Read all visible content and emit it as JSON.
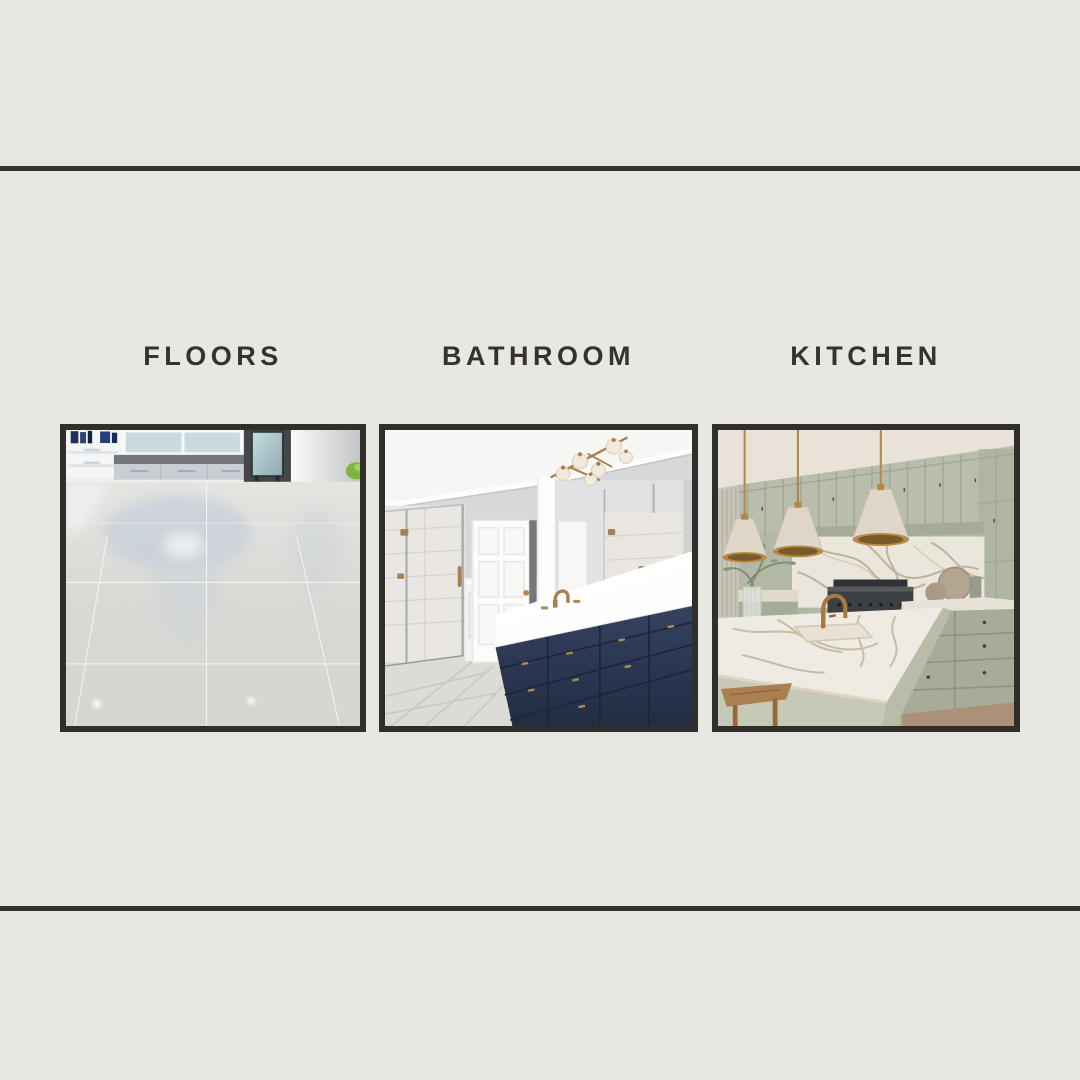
{
  "poster": {
    "background_color": "#e9e7e1",
    "divider_color": "#37342e",
    "label_color": "#36332d",
    "frame_border_color": "#302f2c",
    "accent_brass_color": "#a97f50",
    "accent_navy_color": "#2d3950",
    "accent_sage_color": "#b3b8a6"
  },
  "categories": [
    {
      "label": "FLOORS",
      "photo_description": "Bright room with glossy reflective light-gray tile floor, window bench and cabinets"
    },
    {
      "label": "BATHROOM",
      "photo_description": "White bathroom with glass shower, paneled door, navy vanity, white counter and brass fixtures"
    },
    {
      "label": "KITCHEN",
      "photo_description": "Sage green kitchen with marble backsplash, marble island, brass faucet and cone pendant lights"
    }
  ]
}
